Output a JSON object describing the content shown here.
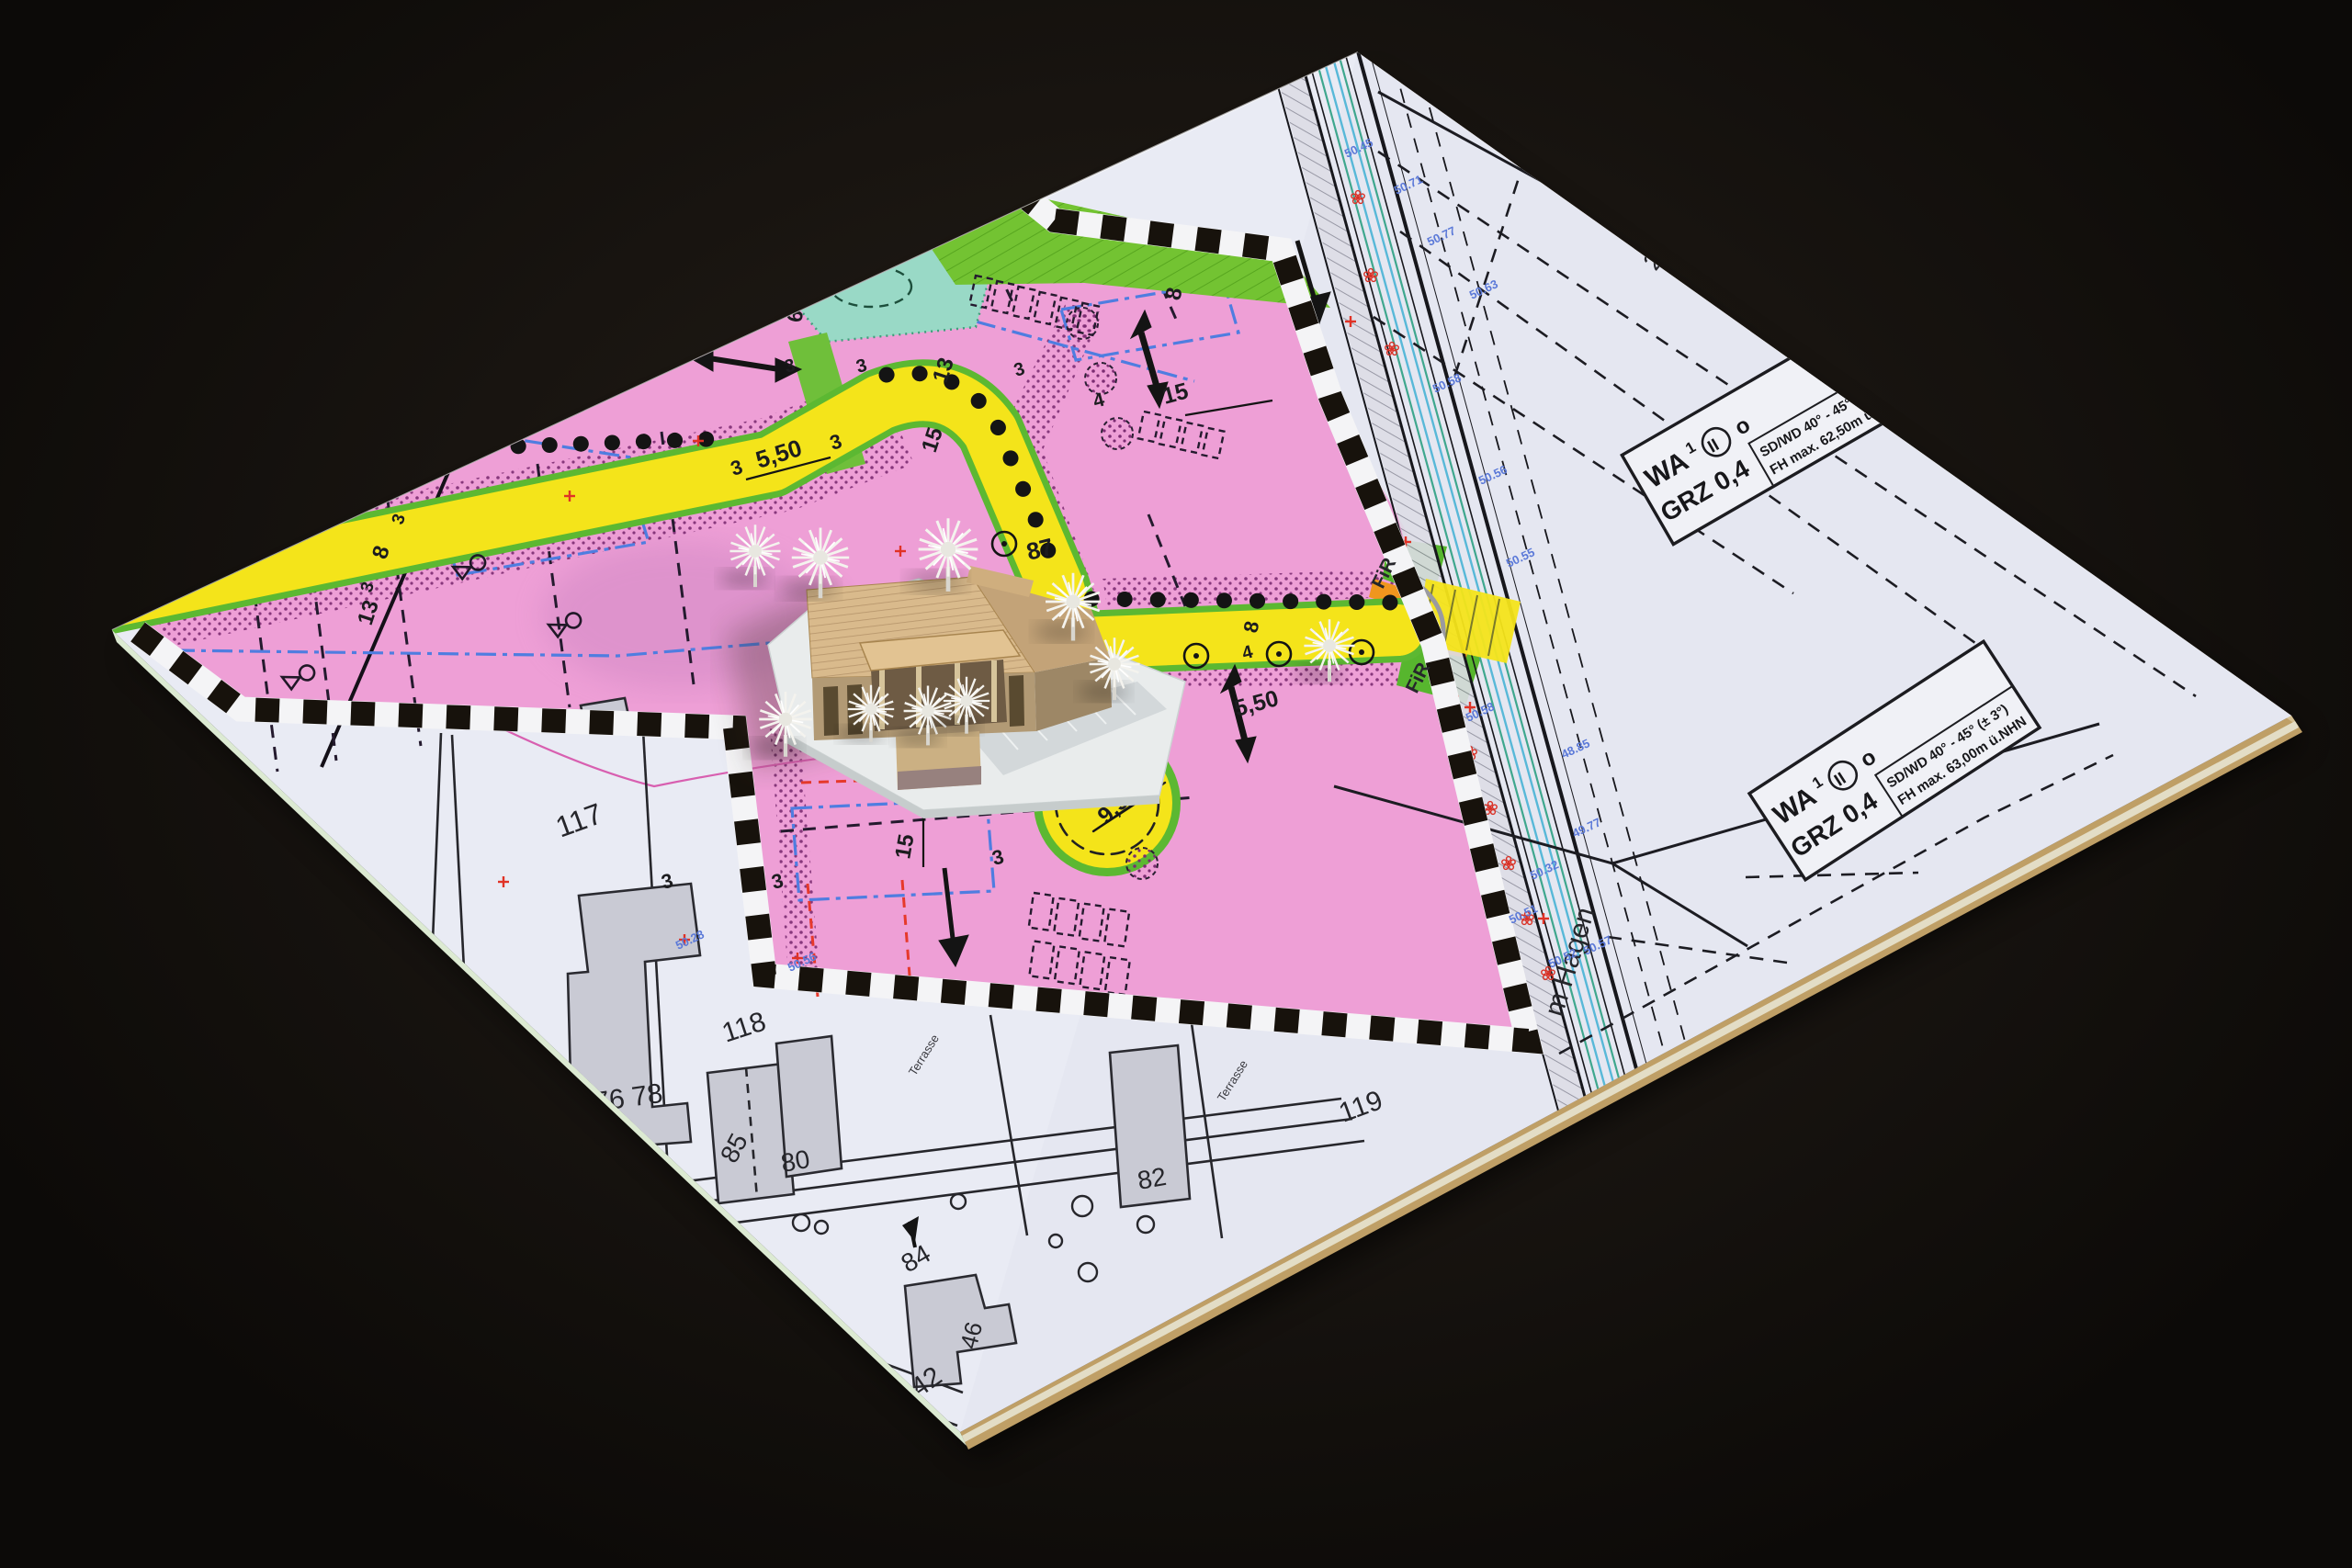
{
  "photo": {
    "colors": {
      "backdrop": "#16120f",
      "board_edge_tan": "#bf9f66",
      "board_edge_pale": "#e3ddc6",
      "sheet_white": "#e9ebf4",
      "zone_pink": "#ee9fd6",
      "road_yellow": "#f4e41a",
      "green_strip": "#73c332",
      "teal_area": "#99d9c6",
      "orange_strip": "#f0961e",
      "boundary_black": "#181209",
      "baugrenze_blue": "#4f7de0",
      "red_dash": "#e6392b",
      "survey_blue": "#5b79d8",
      "model_roof": "#d9ba8c",
      "model_wall": "#b29a75",
      "model_base": "#e9ecec",
      "tree_white": "#f4f3ee",
      "building_gray": "#c9cad4"
    },
    "zone_boxes": [
      {
        "wa": "WA",
        "index": "1",
        "storeys": "II",
        "open": "o",
        "grz": "GRZ 0,4",
        "roof_pitch": "SD/WD 40° - 45° (± 3°)",
        "max_height": "FH max. 62,50m ü.NHN"
      },
      {
        "wa": "WA",
        "index": "1",
        "storeys": "II",
        "open": "o",
        "grz": "GRZ 0,4",
        "roof_pitch": "SD/WD 40° - 45° (± 3°)",
        "max_height": "FH max. 63,00m ü.NHN"
      }
    ],
    "streets": {
      "hagen": "m Hagen",
      "fir_a": "FiR",
      "fir_b": "FiR"
    },
    "parcels": {
      "p27": "27",
      "p117": "117",
      "p118": "118",
      "p119": "119",
      "p85": "85",
      "p84": "84",
      "p42": "42",
      "p46": "46",
      "p76_78": "76 78",
      "p80": "80",
      "p82": "82"
    },
    "annotations": {
      "terrasse_a": "Terrasse",
      "terrasse_b": "Terrasse"
    },
    "dimensions": {
      "d550_top": "5,50",
      "d3_top_l": "3",
      "d3_top_r": "3",
      "d6_road": "6",
      "d14_left": "14",
      "d8_left": "8",
      "d13_left": "13",
      "d3_left_a": "3",
      "d3_left_b": "3",
      "d13_mid": "13",
      "d15_mid": "15",
      "d3_mid": "3",
      "d3_fp_a": "3",
      "d3_fp_b": "3",
      "d8_top": "8",
      "d15_block": "15",
      "d4_strip": "4",
      "d87": "87",
      "d6_model": "6",
      "d550_east": "5,50",
      "d4_east": "4",
      "d8_east": "8",
      "d950": "9,50",
      "d15_env": "15",
      "d3_env_a": "3",
      "d3_env_b": "3",
      "d3_env_c": "3",
      "d3_bot": "3"
    },
    "elevations": {
      "e1": "50.45",
      "e2": "50.71",
      "e3": "50.77",
      "e4": "50.63",
      "e5": "50.58",
      "e6": "50.56",
      "e7": "50.55",
      "e8": "50.58",
      "e9": "48.85",
      "e10": "49.77",
      "e11": "50.32",
      "e12": "50.51",
      "e13": "50.52",
      "e14": "50.57",
      "e15": "50.28",
      "e16": "50.56"
    }
  }
}
